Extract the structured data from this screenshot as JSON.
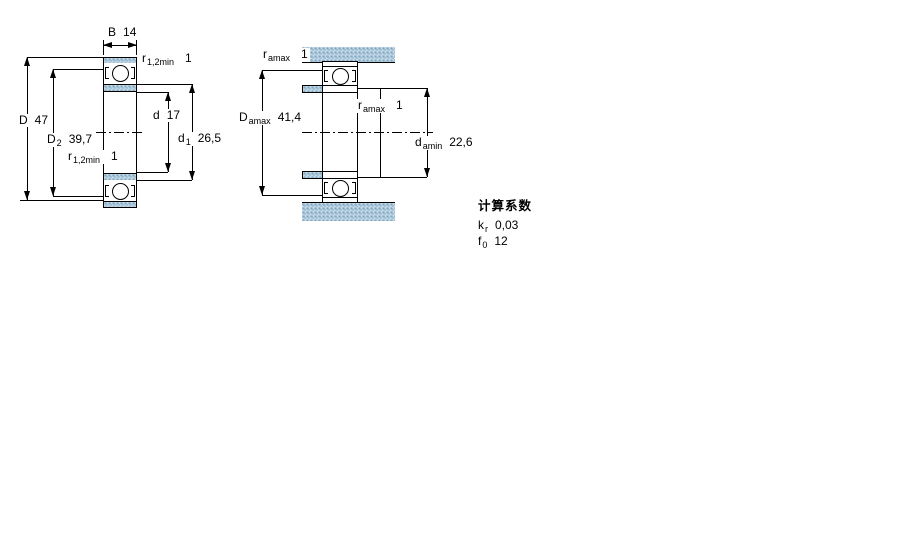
{
  "drawing": {
    "description": "bearing-dimension-drawing",
    "left_figure": {
      "labels": {
        "B": {
          "symbol": "B",
          "value": "14"
        },
        "r12min_top": {
          "symbol": "r",
          "sub": "1,2min",
          "value": "1"
        },
        "D": {
          "symbol": "D",
          "value": "47"
        },
        "D2": {
          "symbol": "D",
          "sub": "2",
          "value": "39,7"
        },
        "r12min_bottom": {
          "symbol": "r",
          "sub": "1,2min",
          "value": "1"
        },
        "d": {
          "symbol": "d",
          "value": "17"
        },
        "d1": {
          "symbol": "d",
          "sub": "1",
          "value": "26,5"
        }
      }
    },
    "right_figure": {
      "labels": {
        "ramax_top": {
          "symbol": "r",
          "sub": "amax",
          "value": "1"
        },
        "Damax": {
          "symbol": "D",
          "sub": "amax",
          "value": "41,4"
        },
        "ramax_mid": {
          "symbol": "r",
          "sub": "amax",
          "value": "1"
        },
        "damin": {
          "symbol": "d",
          "sub": "amin",
          "value": "22,6"
        }
      }
    },
    "calculation_factors": {
      "title": "计算系数",
      "factors": [
        {
          "symbol": "k",
          "sub": "r",
          "value": "0,03"
        },
        {
          "symbol": "f",
          "sub": "0",
          "value": "12"
        }
      ]
    },
    "colors": {
      "hatch_blue": "#c6dae8",
      "hatch_dot": "#84aac4",
      "line": "#000000",
      "background": "#ffffff"
    }
  }
}
